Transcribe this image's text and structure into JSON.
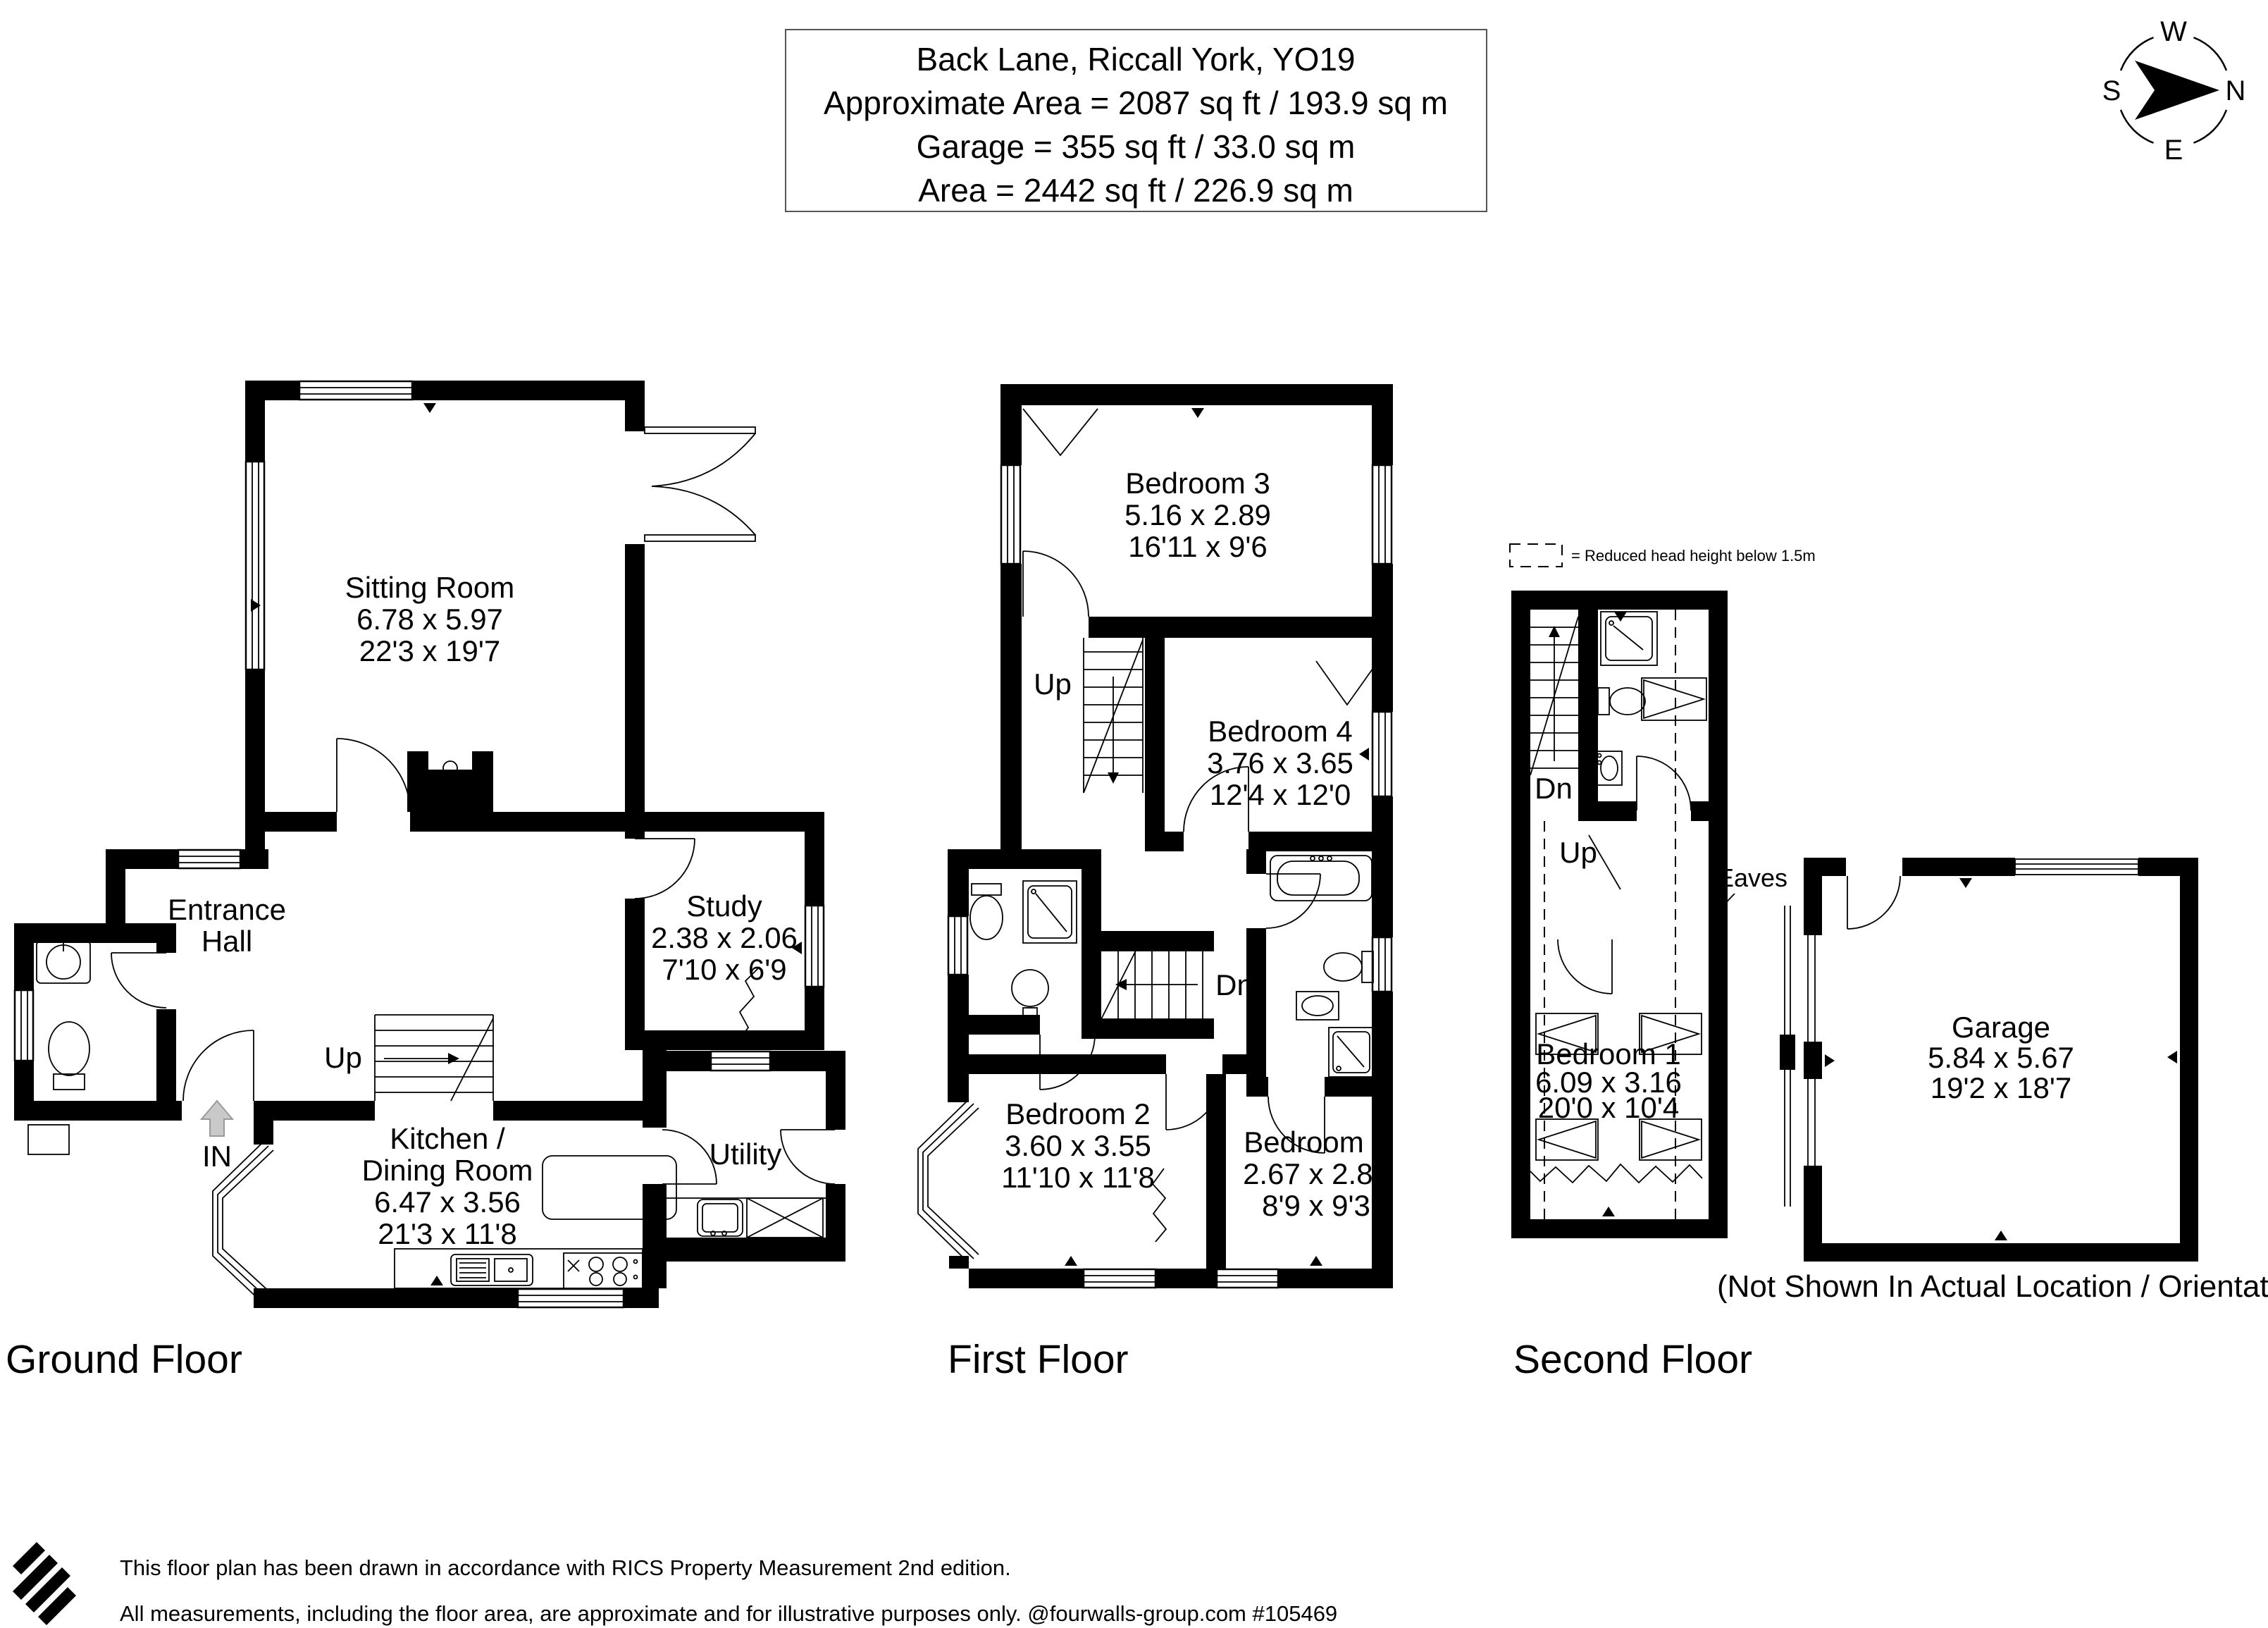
{
  "title_box": {
    "line1": "Back Lane, Riccall York, YO19",
    "line2": "Approximate Area = 2087 sq ft / 193.9 sq m",
    "line3": "Garage = 355 sq ft / 33.0 sq m",
    "line4": "Area = 2442 sq ft / 226.9 sq m"
  },
  "compass": {
    "north": "N",
    "east": "E",
    "south": "S",
    "west": "W"
  },
  "legend": {
    "reduced_head_height": "= Reduced head height below 1.5m"
  },
  "ground_floor": {
    "label": "Ground Floor",
    "sitting_room": {
      "name": "Sitting Room",
      "metric": "6.78 x 5.97",
      "imperial": "22'3 x 19'7"
    },
    "entrance_hall": {
      "name_line1": "Entrance",
      "name_line2": "Hall"
    },
    "study": {
      "name": "Study",
      "metric": "2.38 x 2.06",
      "imperial": "7'10 x 6'9"
    },
    "kitchen_dining": {
      "name_line1": "Kitchen /",
      "name_line2": "Dining Room",
      "metric": "6.47 x 3.56",
      "imperial": "21'3 x 11'8"
    },
    "utility": {
      "name": "Utility"
    },
    "up_label": "Up",
    "in_label": "IN"
  },
  "first_floor": {
    "label": "First Floor",
    "bedroom3": {
      "name": "Bedroom 3",
      "metric": "5.16 x 2.89",
      "imperial": "16'11 x 9'6"
    },
    "bedroom4": {
      "name": "Bedroom 4",
      "metric": "3.76 x 3.65",
      "imperial": "12'4 x 12'0"
    },
    "bedroom2": {
      "name": "Bedroom 2",
      "metric": "3.60 x 3.55",
      "imperial": "11'10 x 11'8"
    },
    "bedroom5": {
      "name": "Bedroom 5",
      "metric": "2.67 x 2.81",
      "imperial": "8'9 x 9'3"
    },
    "up_label": "Up",
    "dn_label": "Dn"
  },
  "second_floor": {
    "label": "Second Floor",
    "bedroom1": {
      "name": "Bedroom 1",
      "metric": "6.09 x 3.16",
      "imperial": "20'0 x 10'4"
    },
    "dn_label": "Dn",
    "up_label": "Up",
    "eaves_label": "Eaves"
  },
  "garage": {
    "name": "Garage",
    "metric": "5.84 x 5.67",
    "imperial": "19'2 x 18'7",
    "caption": "(Not Shown In Actual Location / Orientation)"
  },
  "footer": {
    "line1": "This floor plan has been drawn in accordance with RICS Property Measurement 2nd edition.",
    "line2": "All measurements, including the floor area, are approximate and for illustrative purposes only. @fourwalls-group.com #105469"
  }
}
